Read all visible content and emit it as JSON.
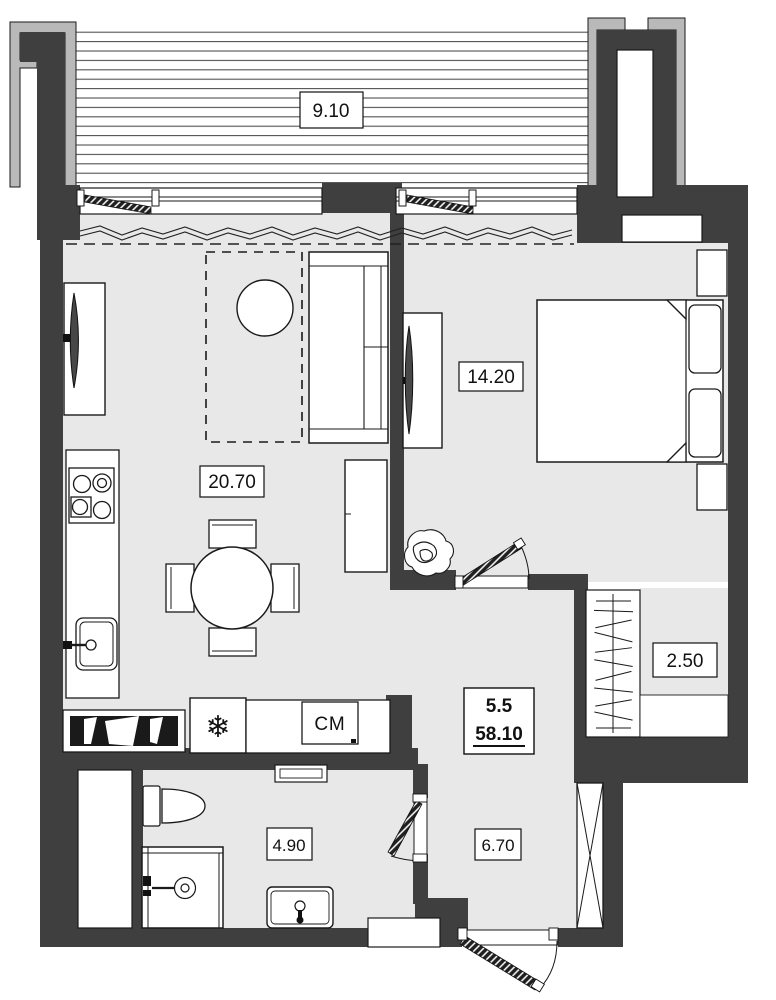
{
  "plan": {
    "type": "apartment-floor-plan",
    "summary": {
      "value_top": "5.5",
      "value_bottom": "58.10"
    },
    "rooms": {
      "balcony": {
        "name": "balcony",
        "area": "9.10"
      },
      "living": {
        "name": "living-kitchen",
        "area": "20.70"
      },
      "bedroom": {
        "name": "bedroom",
        "area": "14.20"
      },
      "closet": {
        "name": "closet",
        "area": "2.50"
      },
      "bathroom": {
        "name": "bathroom",
        "area": "4.90"
      },
      "hallway": {
        "name": "hallway",
        "area": "6.70"
      }
    },
    "appliances": {
      "washer_label": "СМ",
      "fridge_icon": "❄"
    },
    "icons": [
      "snowflake-icon"
    ],
    "colors": {
      "wall": "#3f3f3f",
      "insulation_outline": "#b9b9b9",
      "floor": "#e8e8e8",
      "line": "#1a1a1a",
      "background": "#ffffff"
    }
  }
}
